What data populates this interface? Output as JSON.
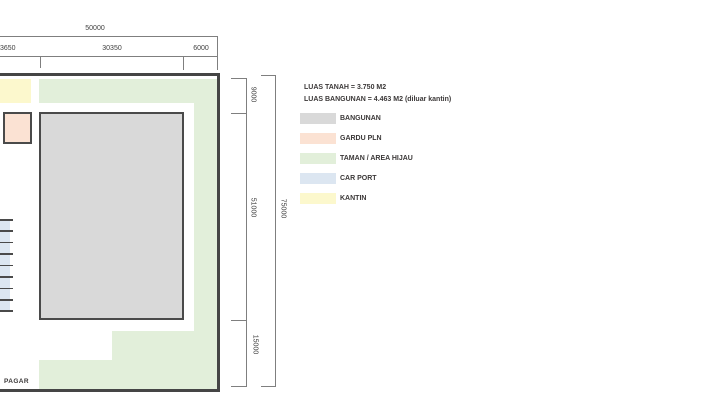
{
  "site_plan": {
    "pagar_label": "PAGAR",
    "carport_stall_count": 8
  },
  "dimensions": {
    "top": {
      "total": "50000",
      "segments": [
        "3650",
        "30350",
        "6000"
      ]
    },
    "right": {
      "segments": [
        "9000",
        "51000",
        "15000"
      ],
      "total": "75000"
    }
  },
  "summary": {
    "line1": "LUAS TANAH = 3.750 M2",
    "line2": "LUAS BANGUNAN = 4.463 M2 (diluar kantin)"
  },
  "legend": {
    "items": [
      {
        "name": "bangunan",
        "label": "BANGUNAN",
        "color": "#d9d9d9"
      },
      {
        "name": "gardu-pln",
        "label": "GARDU PLN",
        "color": "#fbe2d3"
      },
      {
        "name": "taman",
        "label": "TAMAN / AREA HIJAU",
        "color": "#e2efda"
      },
      {
        "name": "car-port",
        "label": "CAR PORT",
        "color": "#dce6f1"
      },
      {
        "name": "kantin",
        "label": "KANTIN",
        "color": "#fcf8cd"
      }
    ]
  },
  "colors": {
    "building_fill": "#d9d9d9",
    "garden": "#e2efda",
    "gardu": "#fbe2d3",
    "carport": "#dce6f1",
    "kantin": "#fcf8cd"
  }
}
